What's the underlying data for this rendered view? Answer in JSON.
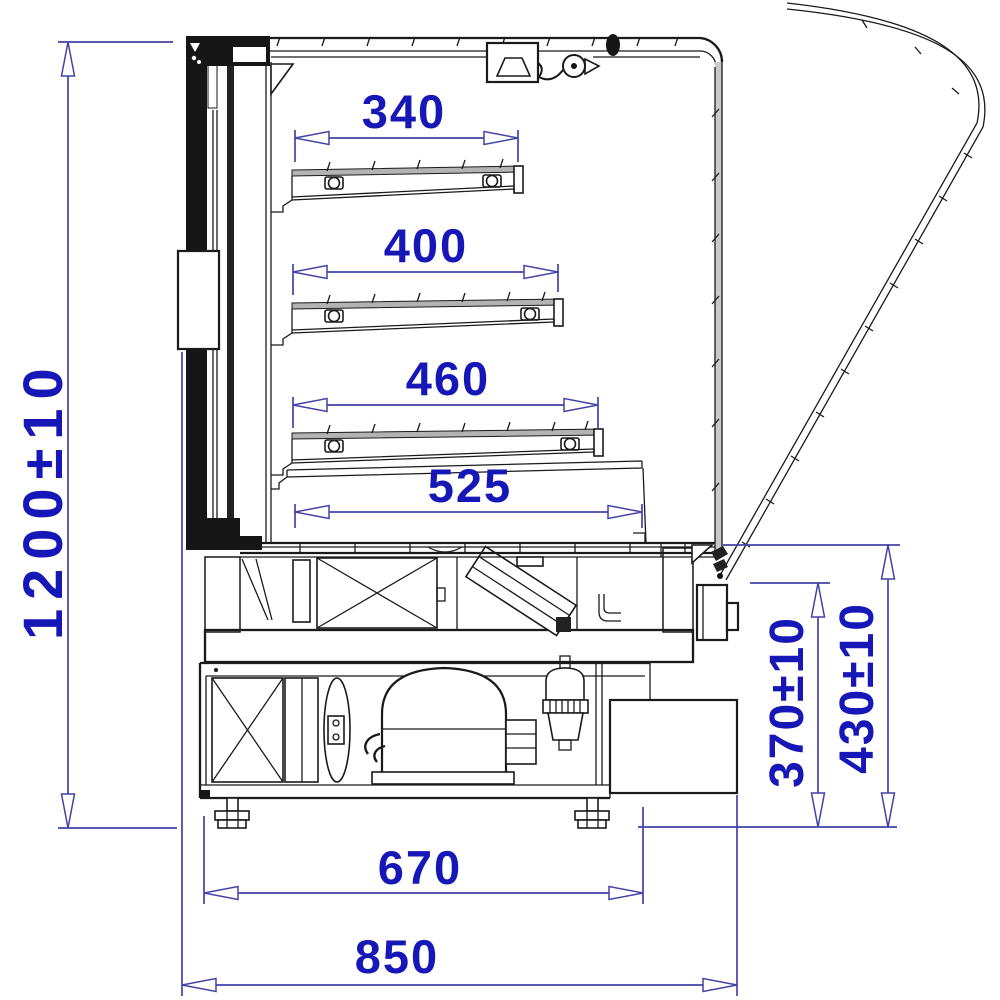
{
  "drawing": {
    "title": "Refrigerated display case — side section technical drawing",
    "units": "mm",
    "colors": {
      "dimension_text": "#1717b8",
      "dimension_line": "#4343a6",
      "drawing_line": "#1a1a1a",
      "background": "#ffffff"
    },
    "dimensions": {
      "overall_height": "1200±10",
      "shelf1_depth": "340",
      "shelf2_depth": "400",
      "shelf3_depth": "460",
      "deck_depth": "525",
      "base_depth": "670",
      "overall_depth": "850",
      "outlet_height": "370±10",
      "counter_height": "430±10"
    }
  }
}
